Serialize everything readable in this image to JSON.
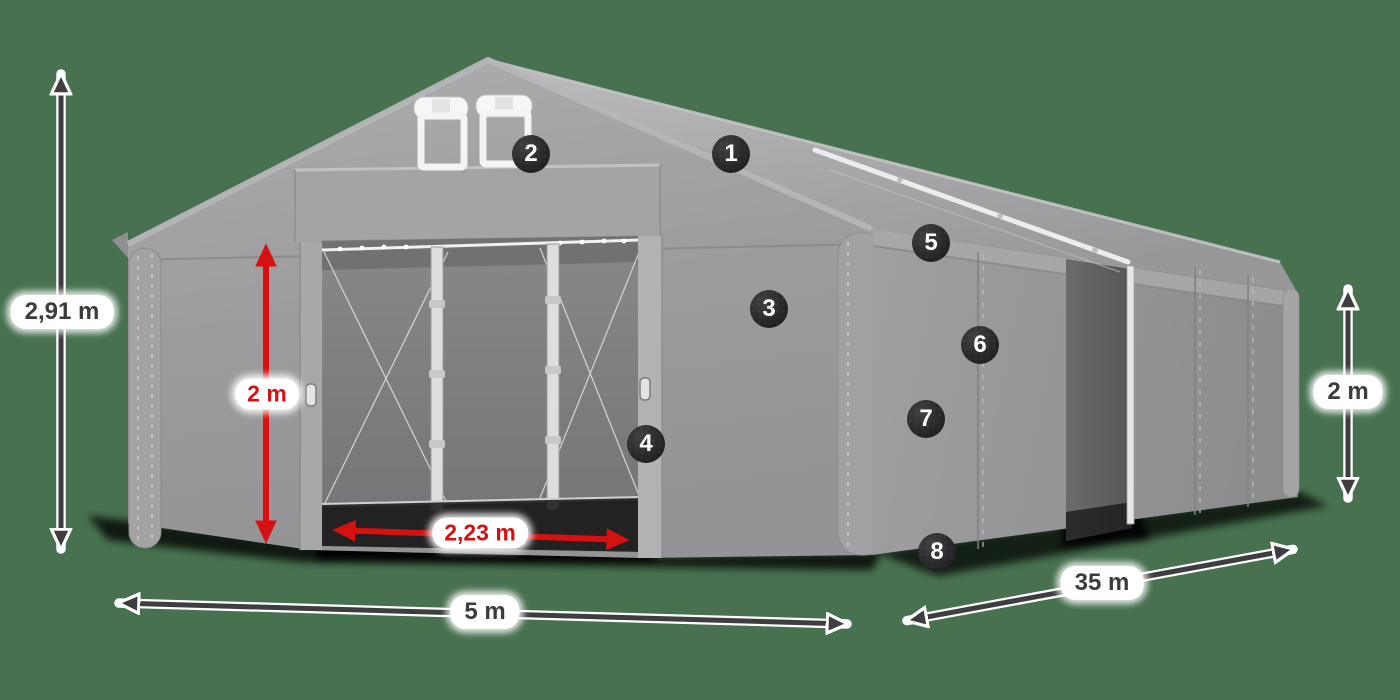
{
  "scene": {
    "description": "storage tent product illustration with dimension annotations",
    "background_color": "#47714f",
    "tent_color": "#9b9b9d",
    "accent_red": "#d51111",
    "arrow_dark": "#3e3e41",
    "badge_color": "#2b2b2e"
  },
  "dimensions": [
    {
      "id": "total-height",
      "label": "2,91 m",
      "style": "dark",
      "pill": {
        "x": 62,
        "y": 312
      },
      "arrow": {
        "x1": 61,
        "y1": 72,
        "x2": 61,
        "y2": 551
      }
    },
    {
      "id": "entrance-height",
      "label": "2 m",
      "style": "red",
      "pill": {
        "x": 267,
        "y": 394
      },
      "arrow": {
        "x1": 266,
        "y1": 243,
        "x2": 266,
        "y2": 544
      }
    },
    {
      "id": "entrance-width",
      "label": "2,23 m",
      "style": "red",
      "pill": {
        "x": 480,
        "y": 533
      },
      "arrow": {
        "x1": 332,
        "y1": 530,
        "x2": 630,
        "y2": 540
      }
    },
    {
      "id": "width",
      "label": "5 m",
      "style": "dark",
      "pill": {
        "x": 485,
        "y": 612
      },
      "arrow": {
        "x1": 117,
        "y1": 603,
        "x2": 849,
        "y2": 624
      }
    },
    {
      "id": "length",
      "label": "35 m",
      "style": "dark",
      "pill": {
        "x": 1102,
        "y": 583
      },
      "arrow": {
        "x1": 905,
        "y1": 621,
        "x2": 1295,
        "y2": 549
      }
    },
    {
      "id": "side-height",
      "label": "2 m",
      "style": "dark",
      "pill": {
        "x": 1348,
        "y": 392
      },
      "arrow": {
        "x1": 1348,
        "y1": 287,
        "x2": 1348,
        "y2": 500
      }
    }
  ],
  "badges": [
    {
      "number": "1",
      "x": 731,
      "y": 154
    },
    {
      "number": "2",
      "x": 531,
      "y": 154
    },
    {
      "number": "3",
      "x": 769,
      "y": 309
    },
    {
      "number": "4",
      "x": 646,
      "y": 444
    },
    {
      "number": "5",
      "x": 931,
      "y": 243
    },
    {
      "number": "6",
      "x": 980,
      "y": 345
    },
    {
      "number": "7",
      "x": 926,
      "y": 419
    },
    {
      "number": "8",
      "x": 937,
      "y": 552
    }
  ]
}
